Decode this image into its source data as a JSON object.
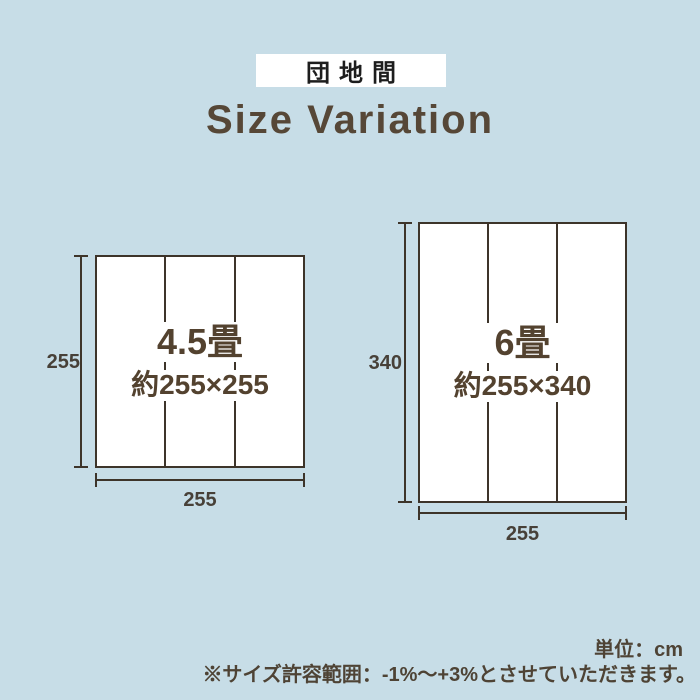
{
  "badge": {
    "label": "団地間"
  },
  "title": "Size Variation",
  "diagrams": [
    {
      "name": "4.5畳",
      "size_label": "約255×255",
      "height_cm": "255",
      "width_cm": "255"
    },
    {
      "name": "6畳",
      "size_label": "約255×340",
      "height_cm": "340",
      "width_cm": "255"
    }
  ],
  "notes": {
    "unit": "単位：cm",
    "tolerance": "※サイズ許容範囲：-1%〜+3%とさせていただきます。"
  },
  "colors": {
    "background": "#c7dde7",
    "line_and_border": "#3d342a",
    "brown_text": "#53422f",
    "title_text": "#564737",
    "dimension_text": "#474038",
    "note_text": "#4e4335",
    "badge_background": "#ffffff",
    "badge_text": "#1d1d1d",
    "mat_fill": "#ffffff"
  }
}
